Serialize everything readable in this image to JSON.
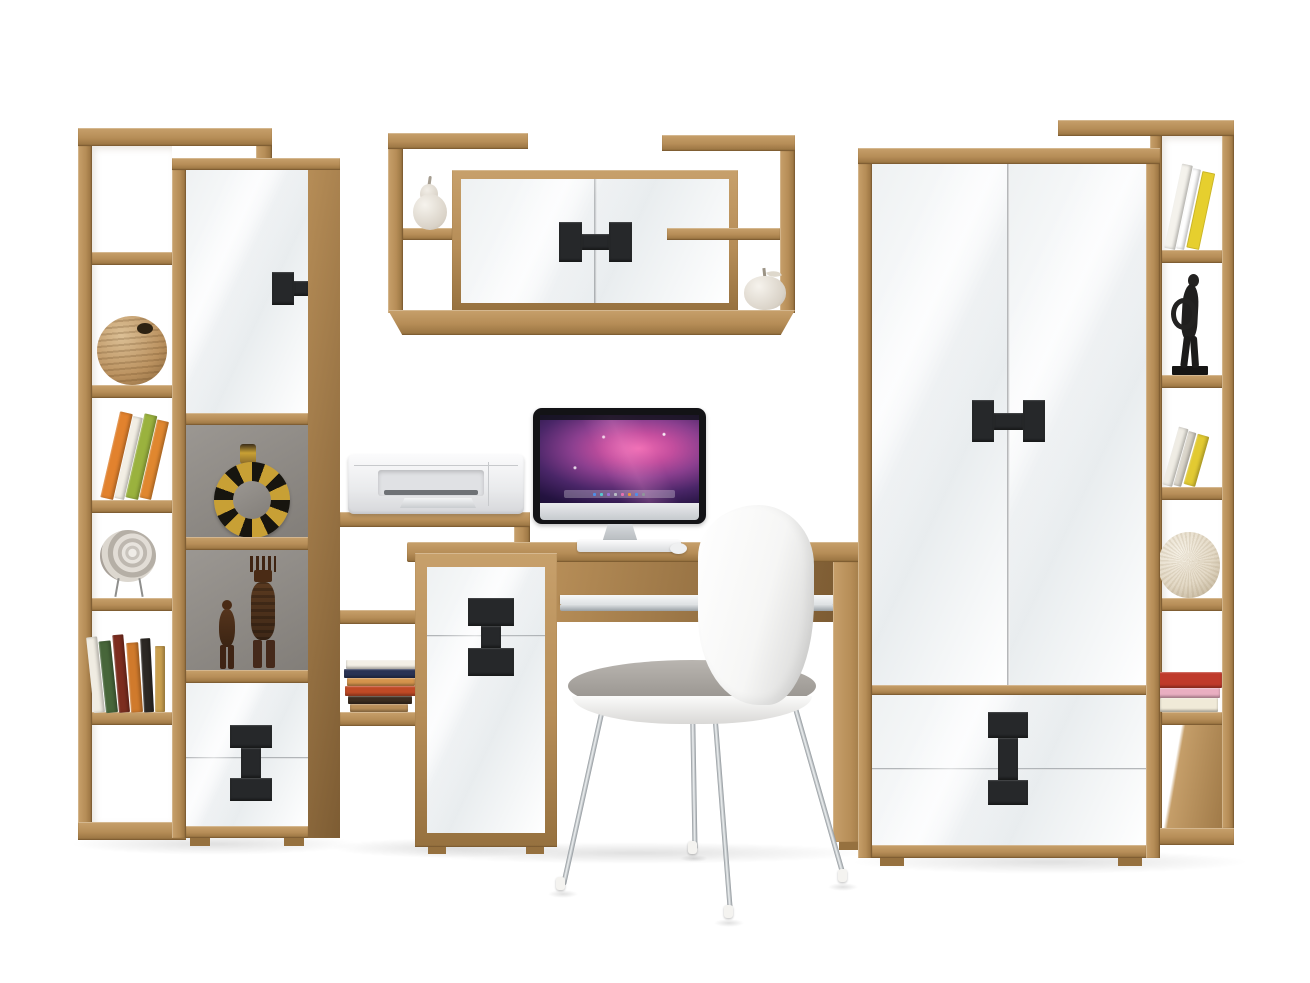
{
  "scene": {
    "description": "Home office furniture wall set in artisan oak and glossy white with desk, chair, all-in-one computer and printer",
    "background": "#ffffff",
    "palette": {
      "oak-light": "#c7a06b",
      "oak": "#b68d57",
      "oak-dark": "#96713f",
      "oak-deep": "#7d5c33",
      "gloss-a": "#eef1f2",
      "gloss-b": "#fbfcfd",
      "handle": "#26282a",
      "niche-a": "#9b9792",
      "niche-b": "#827e79",
      "chrome-a": "#eef1f2",
      "chrome-b": "#8f959a",
      "shadow": "rgba(0,0,0,0.12)"
    },
    "furniture": [
      {
        "id": "left-bookcase",
        "label": "Tall open bookcase (left)"
      },
      {
        "id": "display-cabinet",
        "label": "Display cabinet with door, niches and drawers"
      },
      {
        "id": "stepped-shelf",
        "label": "Stepped open shelving"
      },
      {
        "id": "desk-cabinet",
        "label": "Desk container with drawer and door"
      },
      {
        "id": "desk",
        "label": "Computer desk with keyboard tray"
      },
      {
        "id": "wall-shelf",
        "label": "Wall shelf with two-door cabinet"
      },
      {
        "id": "wardrobe",
        "label": "Two-door wardrobe with two drawers"
      },
      {
        "id": "right-bookcase",
        "label": "Tall open bookcase (right)"
      },
      {
        "id": "chair",
        "label": "White shell chair with chrome legs"
      }
    ],
    "electronics": {
      "imac": {
        "label": "All-in-one desktop computer"
      },
      "keyboard": {
        "label": "White keyboard"
      },
      "mouse": {
        "label": "White mouse"
      },
      "printer": {
        "label": "Compact inkjet printer"
      }
    },
    "imac": {
      "wallpaper": [
        "#140b28",
        "#4a2668",
        "#c44e9e",
        "#ef6ab2"
      ],
      "dock_dots": [
        "#4f8fe8",
        "#58c7d0",
        "#9a6fd8",
        "#b9bec4",
        "#e66fae",
        "#e8953a",
        "#4f8fe8",
        "#8f949a"
      ]
    },
    "decor": [
      {
        "id": "rattan-ball",
        "label": "Rattan ball vase"
      },
      {
        "id": "leaning-books-left",
        "label": "Leaning books"
      },
      {
        "id": "spiral-shell",
        "label": "Spiral shell ornament on wire stand"
      },
      {
        "id": "book-row-left",
        "label": "Row of books"
      },
      {
        "id": "ring-vessel",
        "label": "Ring-shaped ethnic vessel"
      },
      {
        "id": "wood-figurines",
        "label": "Carved wooden figurines"
      },
      {
        "id": "stacked-books-shelf",
        "label": "Stacked books"
      },
      {
        "id": "ceramic-pear",
        "label": "Ceramic pear"
      },
      {
        "id": "ceramic-apple",
        "label": "Ceramic apple"
      },
      {
        "id": "black-sculpture",
        "label": "Black abstract figurine"
      },
      {
        "id": "textured-sphere",
        "label": "Textured decorative sphere"
      },
      {
        "id": "stacked-books-right",
        "label": "Stacked books"
      },
      {
        "id": "leaning-books-right-top",
        "label": "Leaning books"
      },
      {
        "id": "leaning-books-right-mid",
        "label": "Leaning books"
      }
    ],
    "books": {
      "left_leaning": [
        "#e2822e",
        "#f2eee4",
        "#9ab23e",
        "#e0872f"
      ],
      "left_row": [
        "#f0ece2",
        "#47663a",
        "#7c2d1f",
        "#d07a2c",
        "#2c2824",
        "#caa050"
      ],
      "stepped_stack": [
        "#f4f0e6",
        "#2a3354",
        "#d5954d",
        "#c04a26",
        "#3c2d20",
        "#b98e58"
      ],
      "right_top": [
        "#f4f2ec",
        "#ffffff",
        "#e6cf2e"
      ],
      "right_mid": [
        "#efece4",
        "#dbd6cb",
        "#e2ca32"
      ],
      "right_stack": [
        "#bf3a2b",
        "#e9aec1",
        "#f0ead8"
      ]
    }
  }
}
